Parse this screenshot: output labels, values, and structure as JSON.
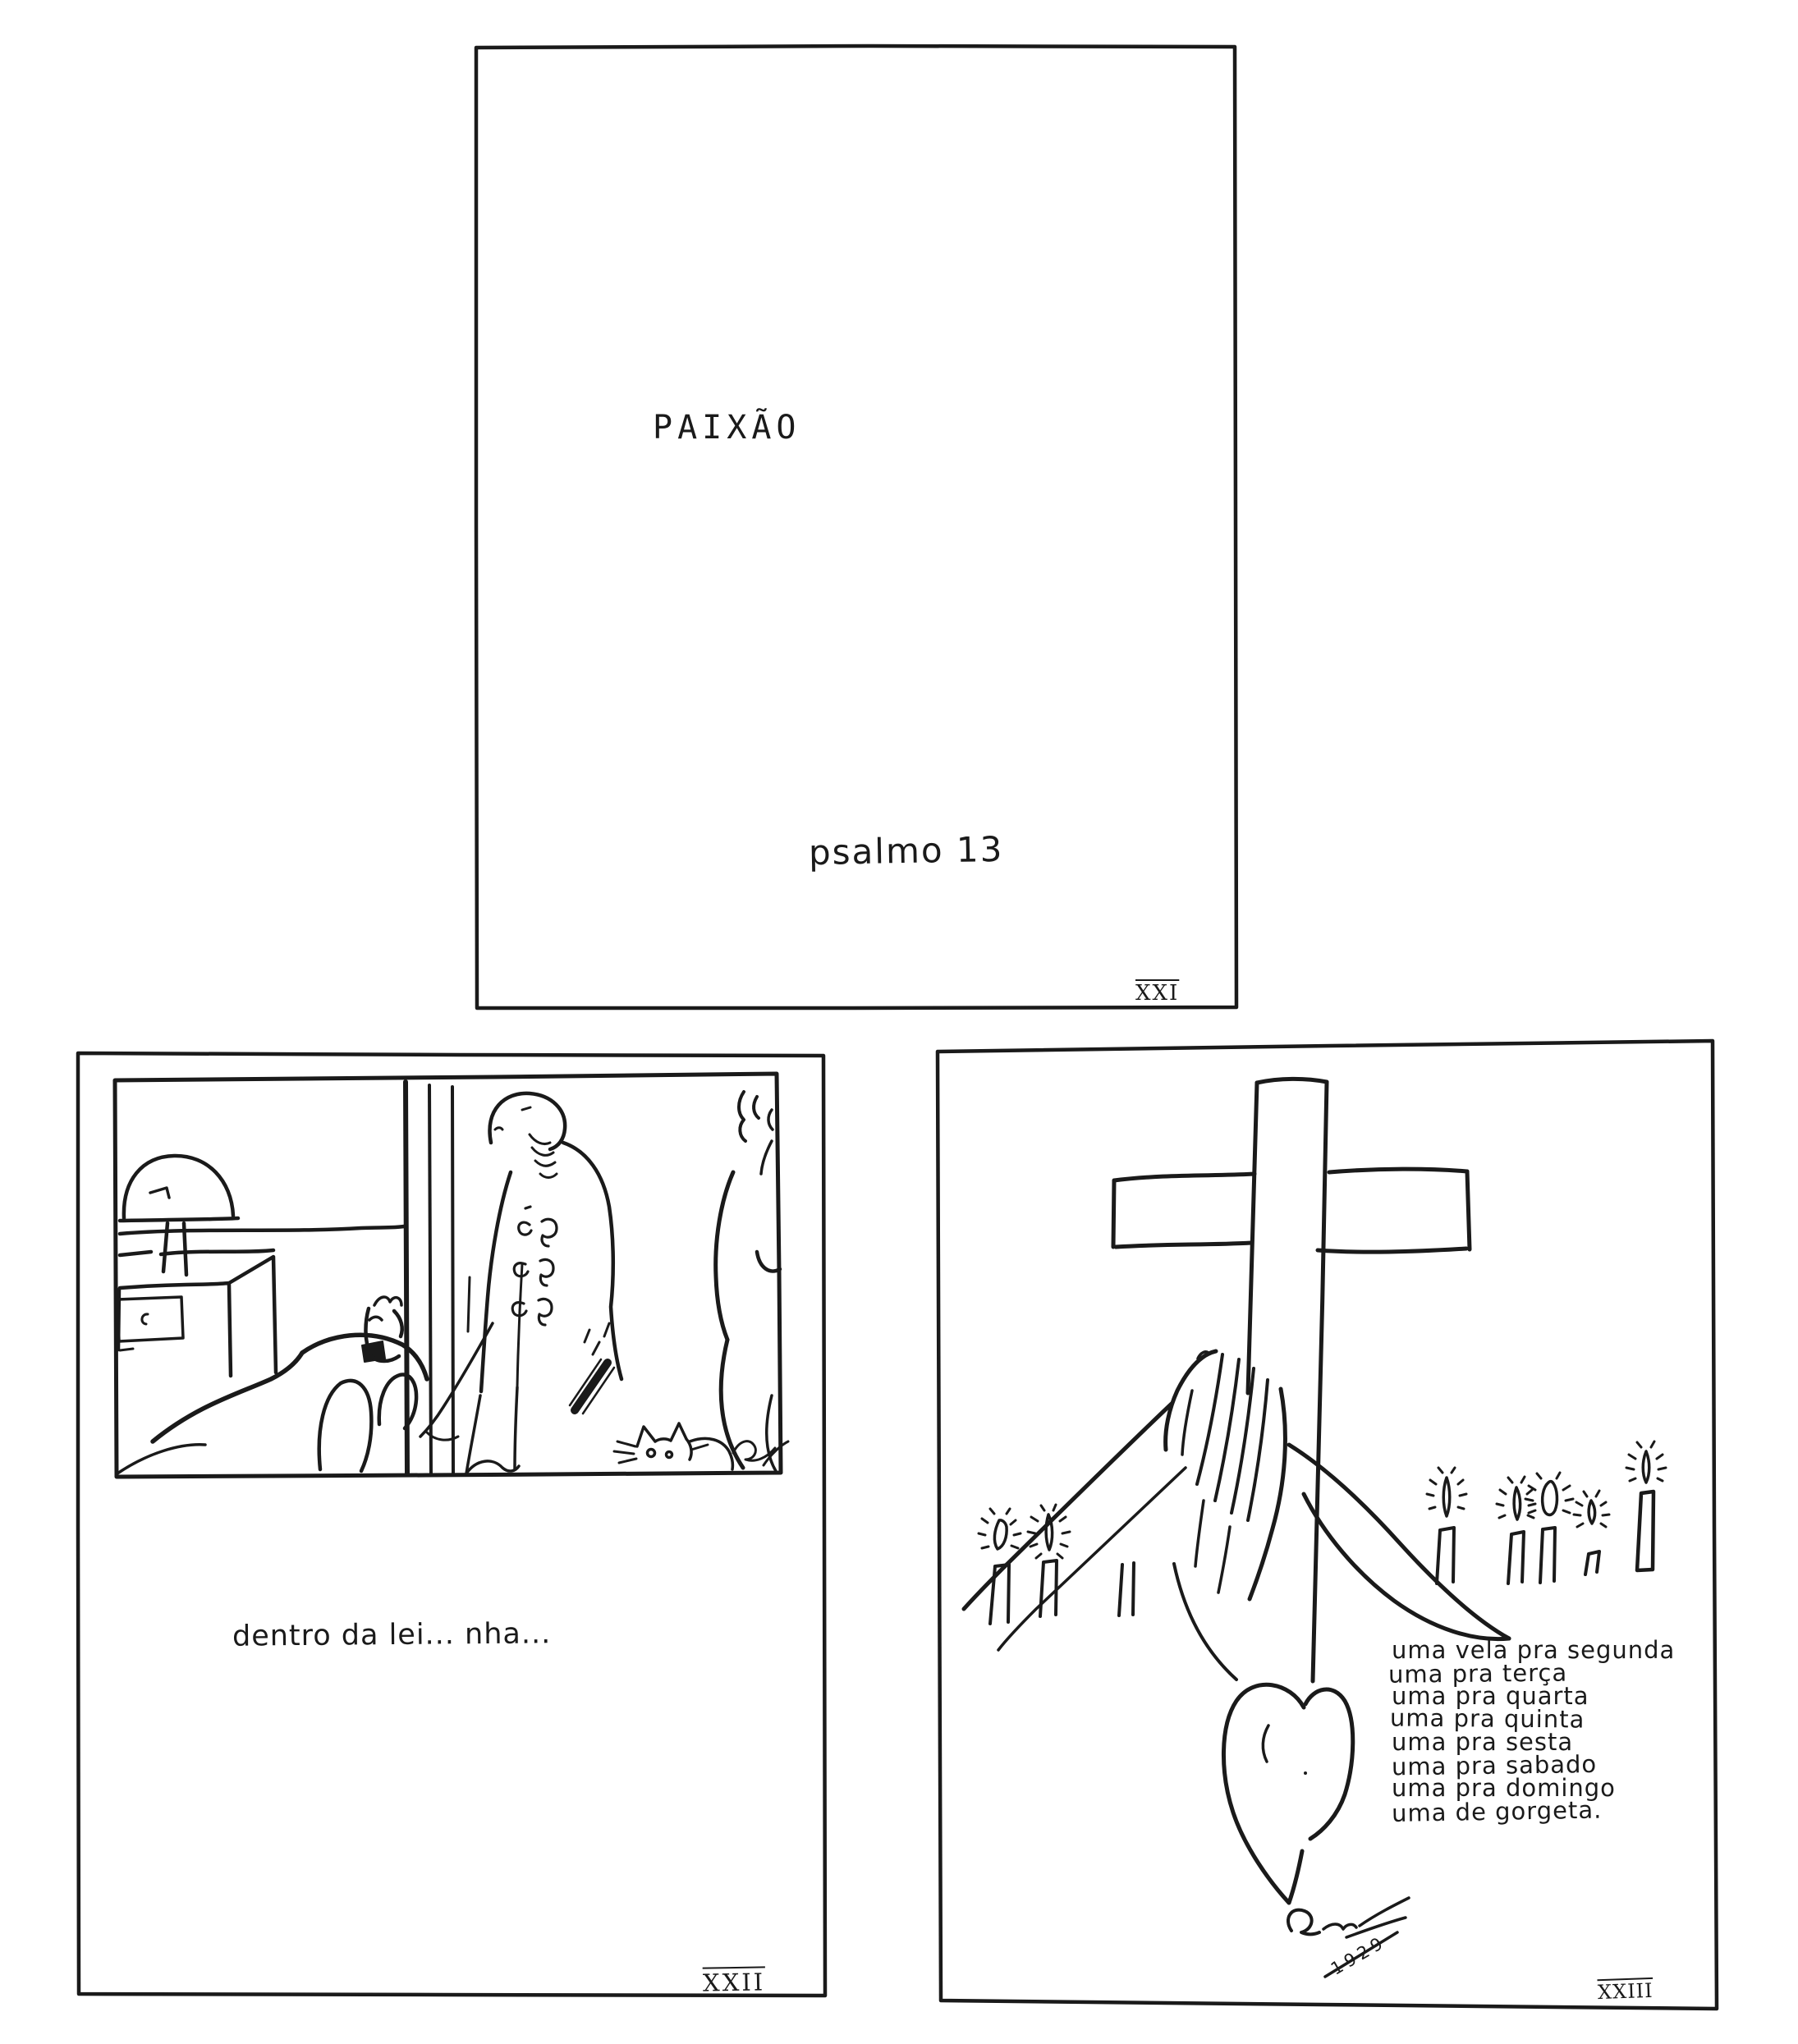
{
  "artwork": {
    "paper_color": "#ffffff",
    "ink_color": "#1a1a1a"
  },
  "page_xxi": {
    "title": "PAIXÃO",
    "subtitle": "psalmo 13",
    "page_number": "XXI"
  },
  "page_xxii": {
    "caption": "dentro da lei... nha...",
    "page_number": "XXII"
  },
  "page_xxiii": {
    "poem_lines": [
      "uma vela pra segunda",
      "uma pra terça",
      "uma pra quarta",
      "uma pra quinta",
      "uma pra sesta",
      "uma pra sabado",
      "uma pra domingo",
      "uma de gorgeta."
    ],
    "signature_year": "1929",
    "page_number": "XXIII"
  }
}
